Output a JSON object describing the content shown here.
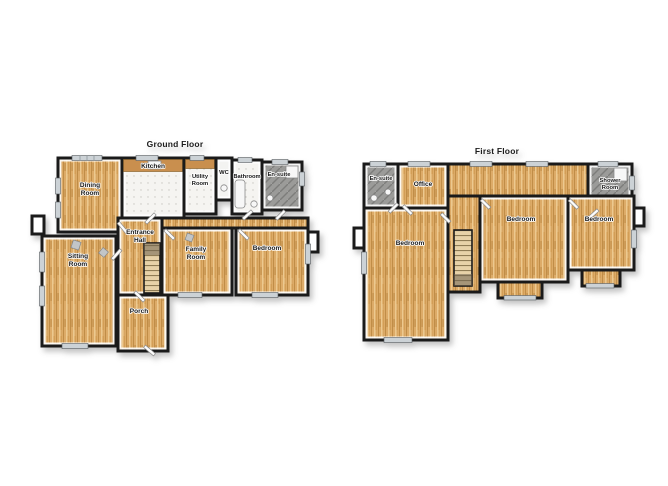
{
  "figure": {
    "type": "floorplan",
    "ground_floor": {
      "title": "Ground Floor",
      "rooms": {
        "dining_room": {
          "line1": "Dining",
          "line2": "Room"
        },
        "kitchen": {
          "line1": "Kitchen"
        },
        "utility_room": {
          "line1": "Utility",
          "line2": "Room"
        },
        "wc": {
          "line1": "WC"
        },
        "bathroom": {
          "line1": "Bathroom"
        },
        "en_suite": {
          "line1": "En-suite"
        },
        "entrance_hall": {
          "line1": "Entrance",
          "line2": "Hall"
        },
        "sitting_room": {
          "line1": "Sitting",
          "line2": "Room"
        },
        "family_room": {
          "line1": "Family",
          "line2": "Room"
        },
        "bedroom": {
          "line1": "Bedroom"
        },
        "porch": {
          "line1": "Porch"
        }
      }
    },
    "first_floor": {
      "title": "First Floor",
      "rooms": {
        "en_suite": {
          "line1": "En-suite"
        },
        "office": {
          "line1": "Office"
        },
        "shower_room": {
          "line1": "Shower",
          "line2": "Room"
        },
        "bedroom_left": {
          "line1": "Bedroom"
        },
        "bedroom_middle": {
          "line1": "Bedroom"
        },
        "bedroom_right": {
          "line1": "Bedroom"
        }
      }
    },
    "palette": {
      "wood_floor": "#ddab68",
      "wood_counter": "#c98f4e",
      "tile_floor": "#f5f4f1",
      "dark_tile_floor": "#9b9b99",
      "wall": "#1a1a1a",
      "window": "#ccd2d6",
      "background": "#ffffff"
    }
  }
}
